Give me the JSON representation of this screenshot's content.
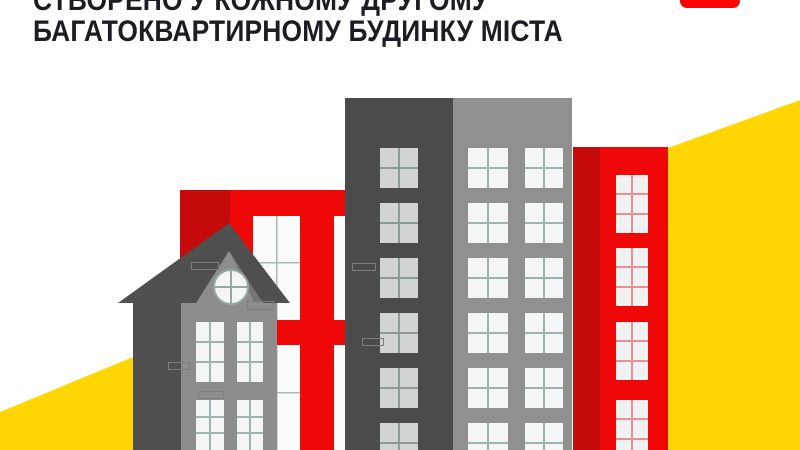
{
  "header": {
    "line1": "СТВОРЕНО У КОЖНОМУ ДРУГОМУ",
    "line2": "БАГАТОКВАРТИРНОМУ БУДИНКУ МІСТА"
  },
  "badge": {
    "icon": "red-logo-icon"
  },
  "illustration": {
    "description": "flat city illustration",
    "elements": [
      "yellow-wedge-left",
      "yellow-wedge-right",
      "red-apartment-building-left",
      "gray-tower-building",
      "red-apartment-building-right",
      "gabled-house",
      "round-attic-window"
    ]
  },
  "colors": {
    "background": "#ffffff",
    "text": "#1c1c22",
    "accent_red": "#ee0808",
    "dark_red": "#c40a0a",
    "badge_red": "#fb0505",
    "yellow": "#ffd502",
    "dark_gray": "#4b4b4b",
    "light_gray": "#909090",
    "house_gray": "#8d8d8d",
    "roof_gray": "#4f4f4f",
    "window_white": "#f4f6f6",
    "window_gray": "#d2d4d4",
    "mullion": "#9fb3b3",
    "red_mullion": "#e89098"
  }
}
